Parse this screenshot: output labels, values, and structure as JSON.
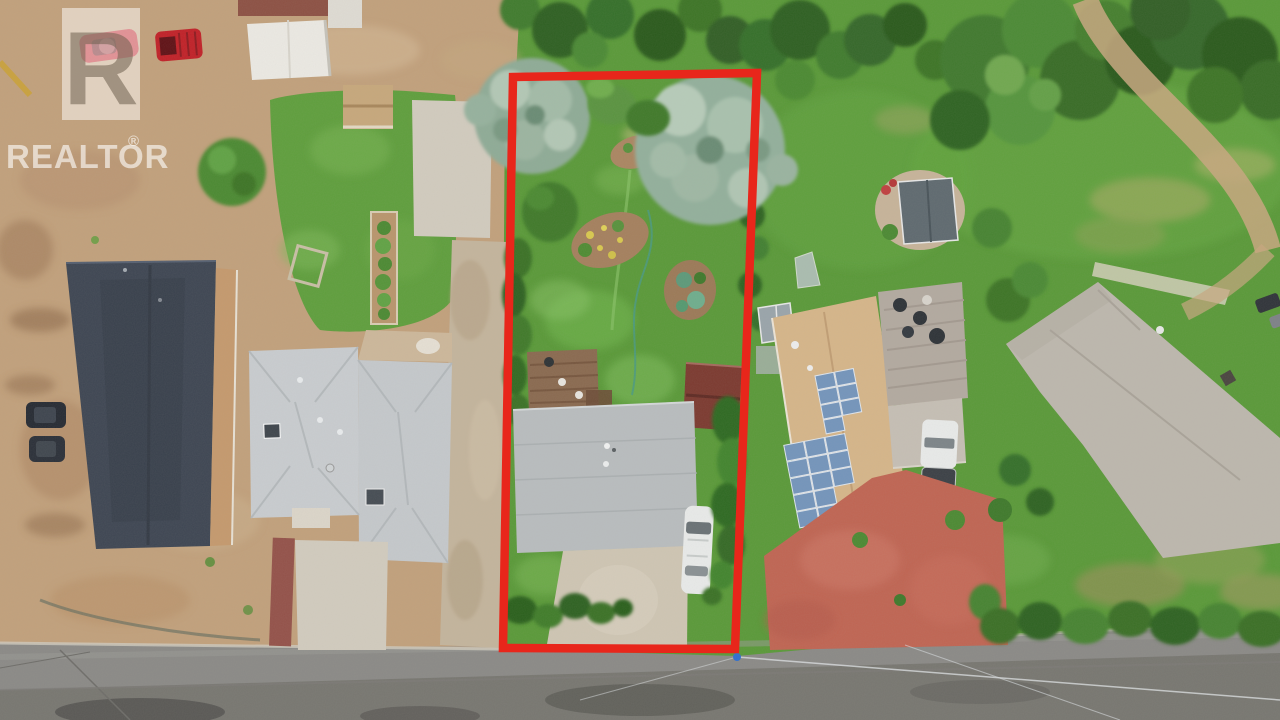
{
  "photo": {
    "description": "Aerial drone photograph of residential lots; subject property outlined in red",
    "type": "real-estate-listing-aerial"
  },
  "watermark": {
    "brand": "REALTOR",
    "registered_symbol": "®",
    "logo_letter": "R"
  },
  "boundary": {
    "color": "#e8261b"
  },
  "colors": {
    "grass_base": "#5a9a39",
    "dirt_base": "#c2a17c",
    "road": "#8b8a87",
    "subject_roof": "#b9bdbf",
    "dark_roof": "#3e4653",
    "neighbor_roof_light": "#c9cdd0",
    "solar_house_roof": "#d6b68a",
    "solar_panel_blue": "#7495bc",
    "far_house_roof": "#bdb8ae",
    "paver_red": "#c06553",
    "concrete": "#d2ccbf",
    "white_vehicle": "#e9ebea",
    "red_vehicle": "#c12128",
    "survey_mark_blue": "#2e6fd0"
  }
}
